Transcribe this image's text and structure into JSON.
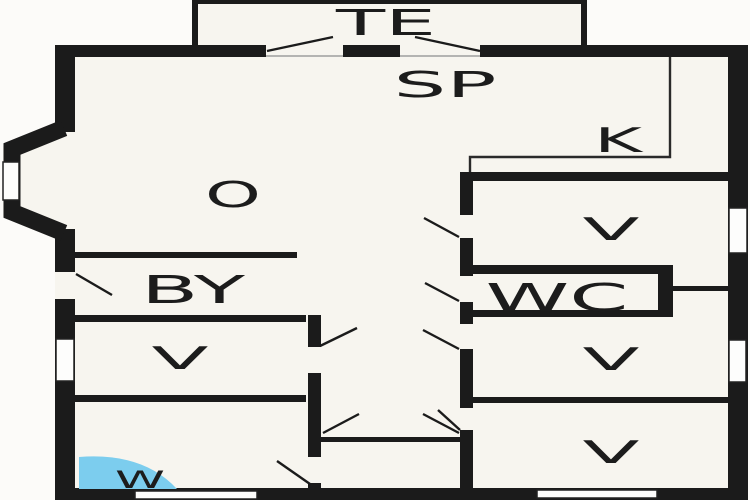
{
  "plan_title": "apartment-floor-plan",
  "colors": {
    "wall": "#1b1b1b",
    "floor": "#f7f5ef",
    "outside": "#fcfbf9",
    "water": "#7ccdee",
    "label": "#1c1c1c"
  },
  "rooms": {
    "terrace": {
      "label": "TE"
    },
    "living": {
      "label": "SP"
    },
    "kitchen": {
      "label": "K"
    },
    "lounge": {
      "label": "O"
    },
    "utility": {
      "label": "BY"
    },
    "toilet": {
      "label": "WC"
    },
    "bath": {
      "label": "W"
    },
    "bedroom_left": {
      "label": "V"
    },
    "bedroom_tr": {
      "label": "V"
    },
    "bedroom_mr": {
      "label": "V"
    },
    "bedroom_br": {
      "label": "V"
    }
  }
}
